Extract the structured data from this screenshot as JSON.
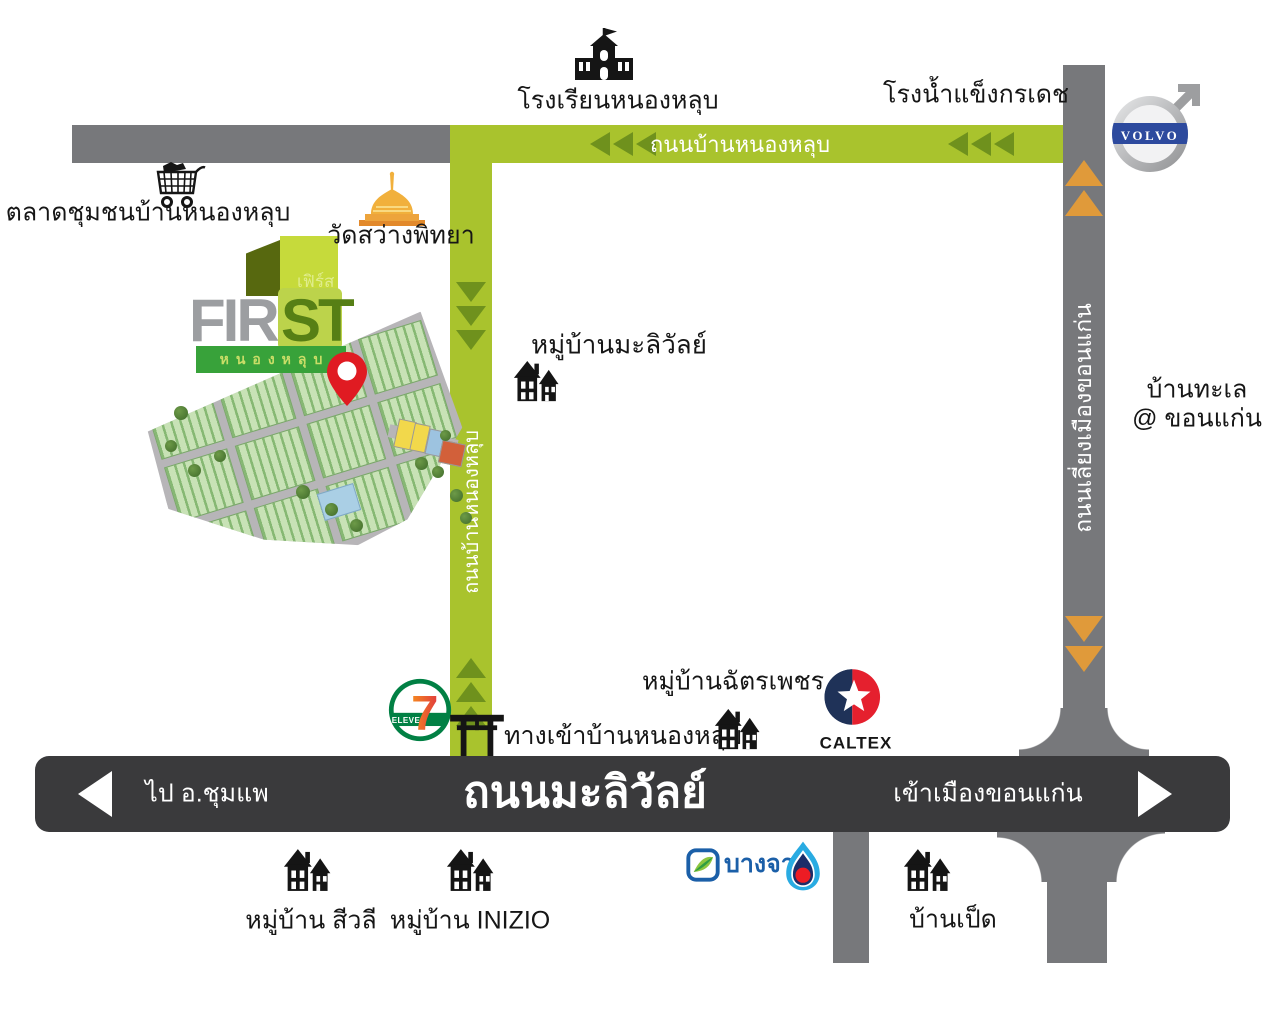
{
  "roads": {
    "ban_nong_lub_h": "ถนนบ้านหนองหลุบ",
    "ban_nong_lub_v": "ถนนบ้านหนองหลุบ",
    "bypass": "ถนนเลี่ยงเมืองขอนแก่น",
    "maliwan": "ถนนมะลิวัลย์",
    "maliwan_west": "ไป อ.ชุมแพ",
    "maliwan_east": "เข้าเมืองขอนแก่น"
  },
  "landmarks": {
    "school": "โรงเรียนหนองหลุบ",
    "ice_factory": "โรงน้ำแข็งกรเดช",
    "market": "ตลาดชุมชนบ้านหนองหลุบ",
    "temple": "วัดสว่างพิทยา",
    "maliwan_village": "หมู่บ้านมะลิวัลย์",
    "ban_talay_1": "บ้านทะเล",
    "ban_talay_2": "@ ขอนแก่น",
    "chatpetch_village": "หมู่บ้านฉัตรเพชร",
    "entrance": "ทางเข้าบ้านหนองหลุบ",
    "sivalee_village": "หมู่บ้าน สีวลี",
    "inizio_village": "หมู่บ้าน INIZIO",
    "ban_ped": "บ้านเป็ด"
  },
  "brands": {
    "volvo": "VOLVO",
    "caltex": "CALTEX",
    "seven": "7",
    "eleven": "ELEVEn",
    "bangchak": "บางจาก"
  },
  "logo": {
    "th": "เฟิร์ส",
    "en_gray": "FIR",
    "en_green": "ST",
    "banner": "หนองหลุบ"
  },
  "colors": {
    "road_green": "#a9c32d",
    "road_gray": "#77787b",
    "road_dark": "#3a3a3c",
    "arrow_green": "#6f911d",
    "arrow_orange": "#e09a3a",
    "pin_red": "#e01b22",
    "banner_green": "#38a23a",
    "logo_cube_front": "#c6da3b",
    "logo_cube_side": "#57680f"
  }
}
